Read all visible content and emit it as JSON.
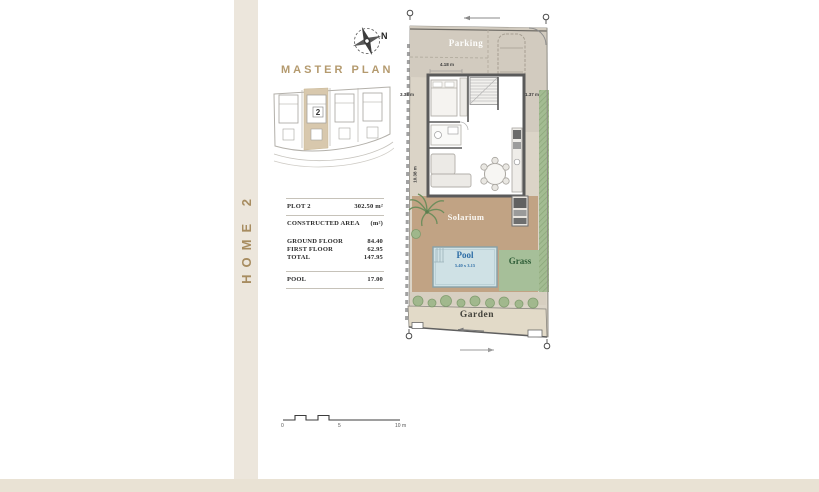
{
  "sidebar": {
    "label": "HOME 2"
  },
  "master_plan": {
    "title": "MASTER PLAN",
    "highlighted_plot": "2"
  },
  "compass": {
    "north_label": "N"
  },
  "info_table": {
    "rows": [
      {
        "label": "PLOT 2",
        "value": "302.50 m²"
      },
      {
        "label": "CONSTRUCTED AREA",
        "value": "(m²)"
      },
      {
        "label": "GROUND FLOOR",
        "value": "84.40"
      },
      {
        "label": "FIRST FLOOR",
        "value": "62.95"
      },
      {
        "label": "TOTAL",
        "value": "147.95"
      },
      {
        "label": "POOL",
        "value": "17.00"
      }
    ]
  },
  "floor_plan": {
    "labels": {
      "parking": "Parking",
      "solarium": "Solarium",
      "pool": "Pool",
      "pool_size": "5.40 x 3.15",
      "grass": "Grass",
      "garden": "Garden"
    },
    "dimensions": {
      "top_width": "4.18 m",
      "left_setback": "3.38 m",
      "right_setback": "1.37 m",
      "side_length": "10.38 m"
    }
  },
  "scale_bar": {
    "zero": "0",
    "five": "5",
    "ten": "10 m"
  },
  "colors": {
    "accent_gold": "#a98e61",
    "sidebar_stripe": "#ece6dc",
    "bottom_band": "#e9e2d4",
    "parking_fill": "#d2cbbf",
    "solarium_fill": "#c1a384",
    "pool_fill": "#cfe1e5",
    "pool_text": "#2d6da6",
    "grass_fill": "#a6bf99",
    "grass_text": "#2f5e38",
    "garden_fill": "#e2dac8",
    "hedge_green": "#a3bc92",
    "wall_gray": "#5a5a5a"
  }
}
